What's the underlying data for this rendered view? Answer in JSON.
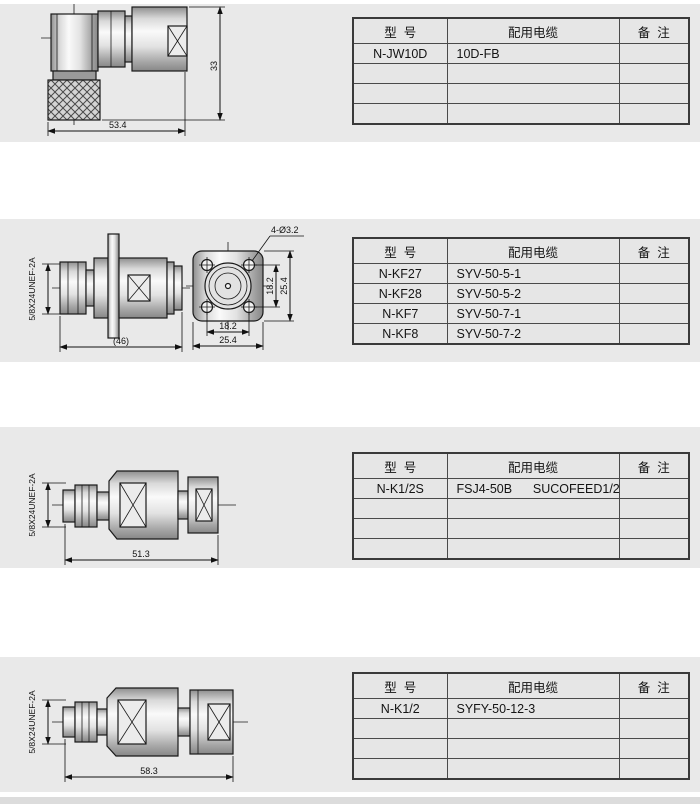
{
  "colors": {
    "band_bg": "#e9e9e9",
    "cell_bg": "#e6e6e6",
    "line": "#1a1a1a",
    "page_bg": "#ffffff"
  },
  "table_headers": [
    "型  号",
    "配用电缆",
    "备  注"
  ],
  "sections": [
    {
      "name": "right-angle-connector",
      "dims": {
        "length": "53.4",
        "height": "33"
      },
      "rows": [
        [
          "N-JW10D",
          "10D-FB",
          ""
        ],
        [
          "",
          "",
          ""
        ],
        [
          "",
          "",
          ""
        ],
        [
          "",
          "",
          ""
        ]
      ]
    },
    {
      "name": "flange-mount-connector",
      "thread": "5/8X24UNEF-2A",
      "dims": {
        "length": "(46)",
        "holes": "4-Ø3.2",
        "pitch_v": "18.2",
        "size_v": "25.4",
        "pitch_h": "18.2",
        "size_h": "25.4"
      },
      "rows": [
        [
          "N-KF27",
          "SYV-50-5-1",
          ""
        ],
        [
          "N-KF28",
          "SYV-50-5-2",
          ""
        ],
        [
          "N-KF7",
          "SYV-50-7-1",
          ""
        ],
        [
          "N-KF8",
          "SYV-50-7-2",
          ""
        ]
      ]
    },
    {
      "name": "straight-clamp-connector-1",
      "thread": "5/8X24UNEF-2A",
      "dims": {
        "length": "51.3"
      },
      "rows": [
        [
          "N-K1/2S",
          "FSJ4-50B      SUCOFEED1/2",
          ""
        ],
        [
          "",
          "",
          ""
        ],
        [
          "",
          "",
          ""
        ],
        [
          "",
          "",
          ""
        ]
      ]
    },
    {
      "name": "straight-clamp-connector-2",
      "thread": "5/8X24UNEF-2A",
      "dims": {
        "length": "58.3"
      },
      "rows": [
        [
          "N-K1/2",
          "SYFY-50-12-3",
          ""
        ],
        [
          "",
          "",
          ""
        ],
        [
          "",
          "",
          ""
        ],
        [
          "",
          "",
          ""
        ]
      ]
    }
  ]
}
